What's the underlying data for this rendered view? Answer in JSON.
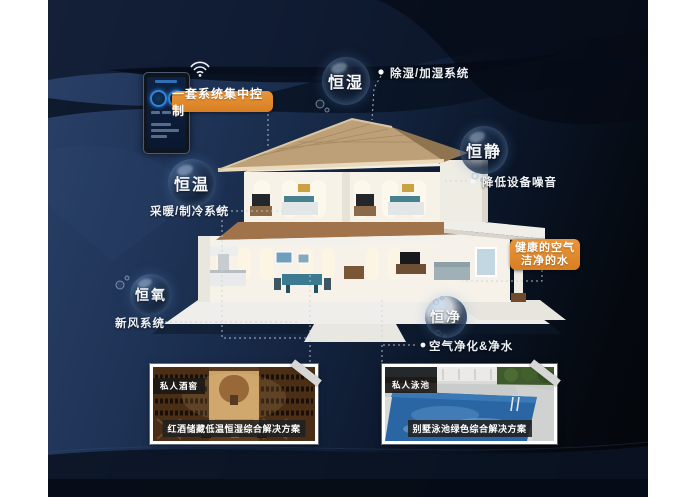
{
  "bubbles": [
    {
      "label": "恒湿",
      "desc": "除湿/加湿系统"
    },
    {
      "label": "恒静",
      "desc": "降低设备噪音"
    },
    {
      "label": "恒温",
      "desc": "采暖/制冷系统"
    },
    {
      "label": "恒氧",
      "desc": "新风系统"
    },
    {
      "label": "恒净",
      "desc": "空气净化&净水"
    }
  ],
  "callouts": {
    "control": "一套系统集中控制",
    "healthy_line1": "健康的空气",
    "healthy_line2": "洁净的水"
  },
  "cards": [
    {
      "tag": "私人酒窖",
      "caption": "红酒储藏低温恒湿综合解决方案"
    },
    {
      "tag": "私人泳池",
      "caption": "别墅泳池绿色综合解决方案"
    }
  ],
  "colors": {
    "accent_orange": "#E0892B",
    "background_navy": "#1E3356",
    "margin_white": "#FFFFFF"
  },
  "icons": {
    "wifi": "wifi-icon"
  }
}
